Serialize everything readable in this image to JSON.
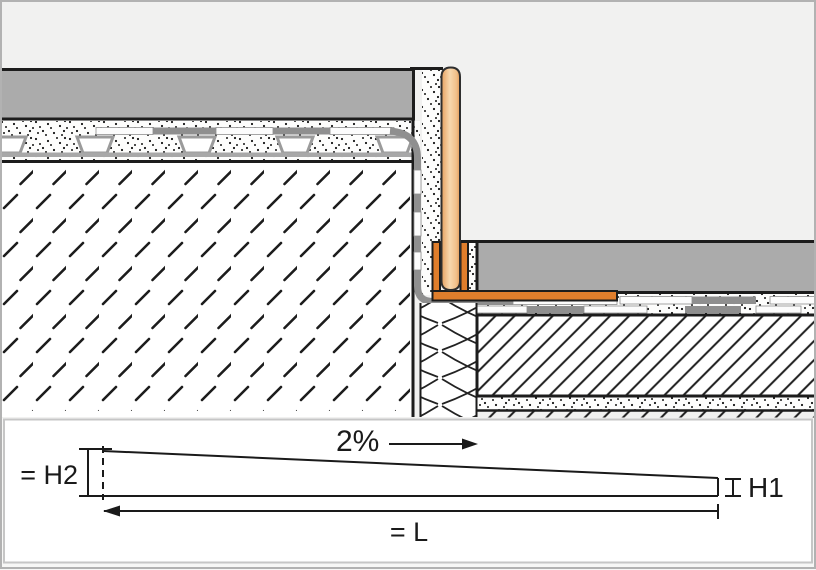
{
  "labels": {
    "slope_percent": "2%",
    "height_left": "= H2",
    "height_right": "H1",
    "length": "= L"
  },
  "diagram": {
    "type": "slope-wedge-schematic",
    "slope": "2%",
    "slope_direction": "right",
    "left_height_label": "= H2",
    "right_height_label": "H1",
    "length_label": "= L"
  },
  "colors": {
    "sky": "#F1F1F0",
    "tile": "#ABABAB",
    "outline": "#1C1C1C",
    "membrane": "#8F8F8F",
    "profile_orange": "#E07E2C",
    "profile_bar_light": "#F2C08F",
    "drainage_gray": "#A8A8A8",
    "panel_border": "#C6C6C6",
    "frame_border": "#B2B2B2"
  }
}
